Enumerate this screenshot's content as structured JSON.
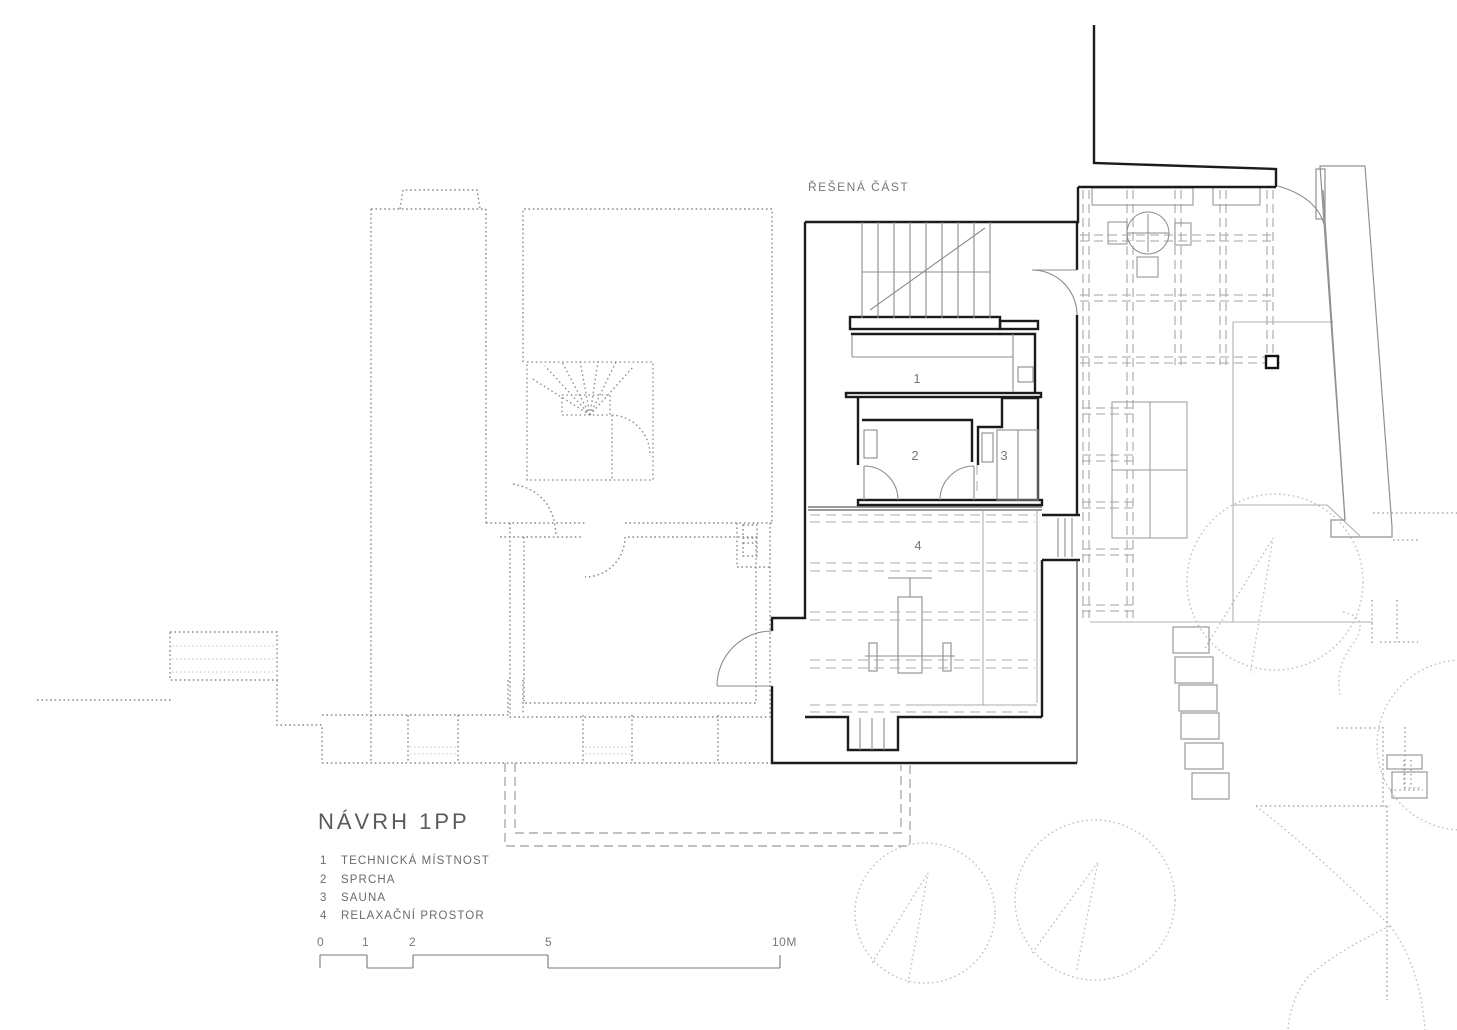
{
  "drawing": {
    "annotation_top": "ŘEŠENÁ ČÁST",
    "title": "NÁVRH 1PP",
    "legend": [
      {
        "number": "1",
        "label": "TECHNICKÁ MÍSTNOST"
      },
      {
        "number": "2",
        "label": "SPRCHA"
      },
      {
        "number": "3",
        "label": "SAUNA"
      },
      {
        "number": "4",
        "label": "RELAXAČNÍ PROSTOR"
      }
    ],
    "scale": {
      "labels": [
        "0",
        "1",
        "2",
        "5",
        "10M"
      ]
    },
    "colors": {
      "wall": "#1b1b1b",
      "thin_line": "#8c8c8c",
      "dashed_line": "#a0a0a0",
      "dotted_line": "#8a8a8a",
      "vegetation": "#bcbcbc",
      "text": "#6b6b6b"
    }
  }
}
